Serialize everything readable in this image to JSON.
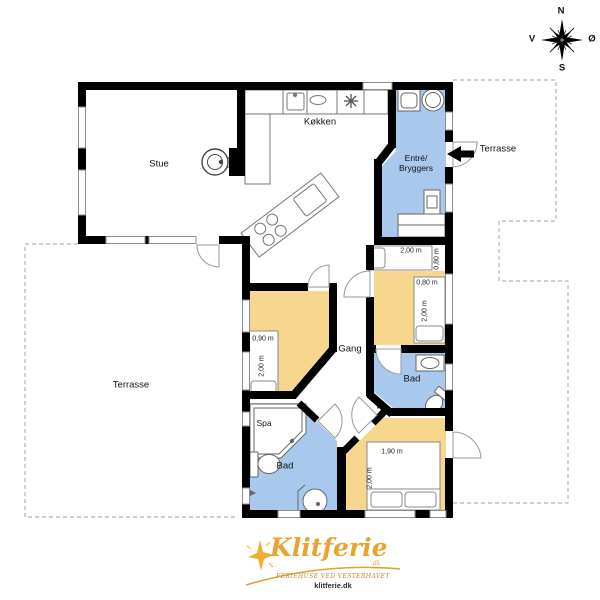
{
  "compass": {
    "north": "N",
    "west": "V",
    "east": "Ø",
    "south": "S"
  },
  "rooms": {
    "stue": "Stue",
    "kokken": "Køkken",
    "entre_line1": "Entré/",
    "entre_line2": "Bryggers",
    "gang": "Gang",
    "bad_right": "Bad",
    "bad_left": "Bad",
    "spa": "Spa",
    "terrasse_left": "Terrasse",
    "terrasse_right": "Terrasse"
  },
  "measurements": {
    "alcove_bed": {
      "width": "2,00 m",
      "depth": "0,80 m"
    },
    "bedroom_right_bed": {
      "width": "0,80 m",
      "length": "2,00 m"
    },
    "bedroom_left_bed": {
      "width": "0,90 m",
      "length": "2,00 m"
    },
    "bedroom_bottom_bed": {
      "width": "1,90 m",
      "length": "2,00 m"
    }
  },
  "logo": {
    "brand": "Klitferie",
    "brand_suffix": ".dk",
    "tagline": "FERIEHUSE VED VESTERHAVET",
    "website": "klitferie.dk"
  },
  "colors": {
    "bedroom_fill": "#f6d78d",
    "bathroom_fill": "#a9c8ee",
    "wall": "#000000",
    "logo_gold": "#e9a42f"
  }
}
